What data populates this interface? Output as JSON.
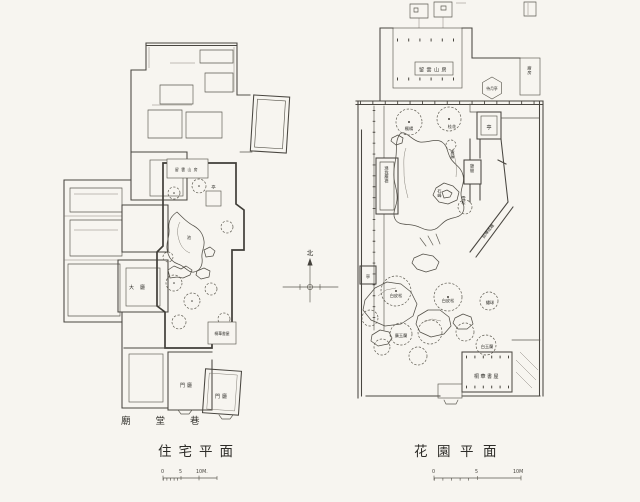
{
  "figure": {
    "description": "Scanned plan drawings of a Suzhou residence and its garden"
  },
  "compass": {
    "north_label": "北"
  },
  "left_plan": {
    "caption": "住宅平面",
    "scale_bar": {
      "t0": "0",
      "t5": "5",
      "t10": "10M."
    },
    "labels": {
      "liuyunshanfang": "留雲山房",
      "ting": "亭",
      "chi": "池",
      "dating": "大廳",
      "tonghuashuwu": "桐華書屋",
      "menting1": "門廳",
      "menting2": "門廳",
      "street": "廟堂巷"
    }
  },
  "right_plan": {
    "caption": "花園平面",
    "scale_bar": {
      "t0": "0",
      "t5": "5",
      "t10": "10M"
    },
    "labels": {
      "liuyunshanfang": "留雲山房",
      "chufang": "廚房",
      "daiyueting": "待月亭",
      "fengyang": "楓楊",
      "guihua": "桂花",
      "ting_east": "亭",
      "ziteng": "紫藤",
      "qijian": "憩間",
      "diwochenjin": "滌我塵襟",
      "shifeng": "石峰",
      "xuesong": "雪松",
      "yanhuichengqu": "延暉成趣",
      "ting_west": "亭",
      "baipisong1": "白皮松",
      "baipisong2": "白皮松",
      "xiuqiu": "繡球",
      "guangyulan": "廣玉蘭",
      "baiyulan": "白玉蘭",
      "tonghuashuwu": "桐華書屋"
    }
  }
}
